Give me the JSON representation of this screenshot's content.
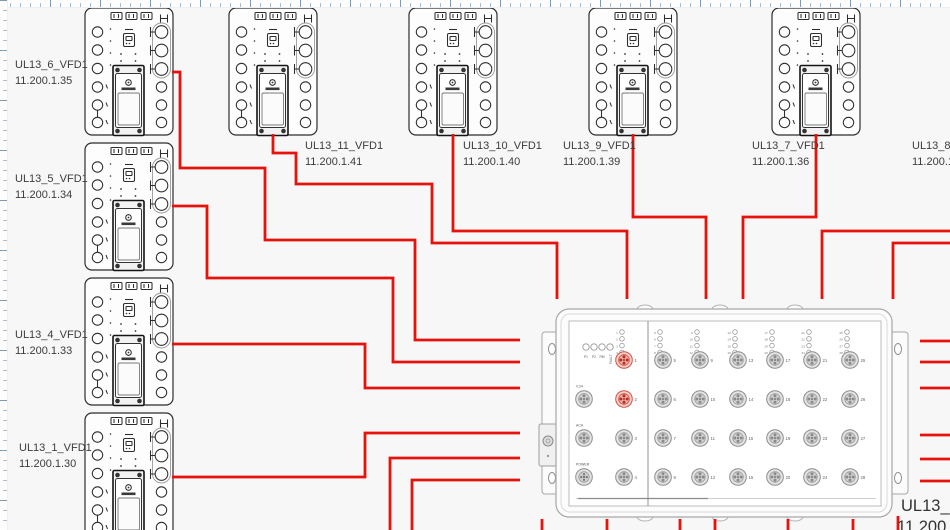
{
  "canvas": {
    "width": 950,
    "height": 530,
    "background": "#f7f7f8"
  },
  "palette": {
    "cable": "#e8120c",
    "device_stroke": "#2d2d2d",
    "switch_stroke": "#a7a7a7",
    "label_color": "#3c3c3c",
    "port_highlight_fill": "#f8cdc8",
    "port_highlight_stroke": "#cf5549"
  },
  "devices": [
    {
      "name": "UL13_6_VFD1",
      "ip": "11.200.1.35",
      "x": 84,
      "y": 7,
      "label_x": 15,
      "label_y": 58
    },
    {
      "name": "UL13_5_VFD1",
      "ip": "11.200.1.34",
      "x": 84,
      "y": 142,
      "label_x": 15,
      "label_y": 172
    },
    {
      "name": "UL13_4_VFD1",
      "ip": "11.200.1.33",
      "x": 84,
      "y": 277,
      "label_x": 15,
      "label_y": 328
    },
    {
      "name": "UL13_1_VFD1",
      "ip": "11.200.1.30",
      "x": 84,
      "y": 412,
      "label_x": 19,
      "label_y": 441
    },
    {
      "name": "UL13_11_VFD1",
      "ip": "11.200.1.41",
      "x": 228,
      "y": 7,
      "label_x": 305,
      "label_y": 139
    },
    {
      "name": "UL13_10_VFD1",
      "ip": "11.200.1.40",
      "x": 408,
      "y": 7,
      "label_x": 463,
      "label_y": 139
    },
    {
      "name": "UL13_9_VFD1",
      "ip": "11.200.1.39",
      "x": 588,
      "y": 7,
      "label_x": 563,
      "label_y": 139
    },
    {
      "name": "UL13_7_VFD1",
      "ip": "11.200.1.36",
      "x": 771,
      "y": 7,
      "label_x": 752,
      "label_y": 139
    }
  ],
  "clipped_label": {
    "name": "UL13_8",
    "ip": "11.200.1"
  },
  "switch": {
    "label": "UL13_",
    "label_ip": "11.200",
    "status_leds": [
      "P1",
      "P2",
      "RM",
      "FAULT"
    ],
    "aux_ports": [
      "V.24",
      "ACA",
      "POWER"
    ],
    "base_ports": [
      1,
      2,
      3,
      4
    ],
    "port_columns": [
      [
        5,
        6,
        7,
        8
      ],
      [
        9,
        10,
        11,
        12
      ],
      [
        13,
        14,
        15,
        16
      ],
      [
        17,
        18,
        19,
        20
      ],
      [
        21,
        22,
        23,
        24
      ],
      [
        25,
        26,
        27,
        28
      ]
    ],
    "highlighted_ports": [
      1,
      2
    ]
  },
  "cables": [
    {
      "id": "cable-UL13_6_VFD1",
      "points": [
        [
          172,
          72
        ],
        [
          180,
          72
        ],
        [
          180,
          168
        ],
        [
          265,
          168
        ],
        [
          265,
          240
        ],
        [
          415,
          240
        ],
        [
          415,
          340
        ],
        [
          520,
          340
        ]
      ]
    },
    {
      "id": "cable-UL13_5_VFD1",
      "points": [
        [
          172,
          206
        ],
        [
          207,
          206
        ],
        [
          207,
          278
        ],
        [
          393,
          278
        ],
        [
          393,
          362
        ],
        [
          520,
          362
        ]
      ]
    },
    {
      "id": "cable-UL13_4_VFD1",
      "points": [
        [
          172,
          344
        ],
        [
          365,
          344
        ],
        [
          365,
          388
        ],
        [
          520,
          388
        ]
      ]
    },
    {
      "id": "cable-UL13_1_VFD1",
      "points": [
        [
          172,
          477
        ],
        [
          365,
          477
        ],
        [
          365,
          433
        ],
        [
          520,
          433
        ]
      ]
    },
    {
      "id": "cable-bottom-feed-a",
      "points": [
        [
          390,
          530
        ],
        [
          390,
          458
        ],
        [
          520,
          458
        ]
      ]
    },
    {
      "id": "cable-bottom-feed-b",
      "points": [
        [
          412,
          530
        ],
        [
          412,
          480
        ],
        [
          520,
          480
        ]
      ]
    },
    {
      "id": "cable-UL13_11_VFD1",
      "points": [
        [
          273,
          134
        ],
        [
          273,
          153
        ],
        [
          296,
          153
        ],
        [
          296,
          184
        ],
        [
          432,
          184
        ],
        [
          432,
          243
        ],
        [
          557,
          243
        ],
        [
          557,
          299
        ]
      ]
    },
    {
      "id": "cable-UL13_10_VFD1",
      "points": [
        [
          453,
          134
        ],
        [
          453,
          231
        ],
        [
          627,
          231
        ],
        [
          627,
          299
        ]
      ]
    },
    {
      "id": "cable-UL13_9_VFD1",
      "points": [
        [
          633,
          134
        ],
        [
          633,
          217
        ],
        [
          706,
          217
        ],
        [
          706,
          299
        ]
      ]
    },
    {
      "id": "cable-UL13_7_VFD1",
      "points": [
        [
          816,
          134
        ],
        [
          816,
          217
        ],
        [
          743,
          217
        ],
        [
          743,
          299
        ]
      ]
    },
    {
      "id": "cable-right-feed-a",
      "points": [
        [
          950,
          231
        ],
        [
          822,
          231
        ],
        [
          822,
          299
        ]
      ]
    },
    {
      "id": "cable-right-feed-b",
      "points": [
        [
          950,
          243
        ],
        [
          893,
          243
        ],
        [
          893,
          299
        ]
      ]
    },
    {
      "id": "cable-stub-b1",
      "points": [
        [
          542,
          519
        ],
        [
          542,
          530
        ]
      ]
    },
    {
      "id": "cable-stub-b2",
      "points": [
        [
          607,
          519
        ],
        [
          607,
          530
        ]
      ]
    },
    {
      "id": "cable-stub-b3",
      "points": [
        [
          680,
          519
        ],
        [
          680,
          530
        ]
      ]
    },
    {
      "id": "cable-stub-b4",
      "points": [
        [
          715,
          519
        ],
        [
          715,
          530
        ]
      ]
    },
    {
      "id": "cable-stub-b5",
      "points": [
        [
          788,
          519
        ],
        [
          788,
          530
        ]
      ]
    },
    {
      "id": "cable-stub-b6",
      "points": [
        [
          853,
          519
        ],
        [
          853,
          530
        ]
      ]
    },
    {
      "id": "cable-stub-b7",
      "points": [
        [
          898,
          516
        ],
        [
          898,
          530
        ]
      ]
    },
    {
      "id": "cable-stub-r1",
      "points": [
        [
          920,
          341
        ],
        [
          950,
          341
        ]
      ]
    },
    {
      "id": "cable-stub-r2",
      "points": [
        [
          920,
          362
        ],
        [
          950,
          362
        ]
      ]
    },
    {
      "id": "cable-stub-r3",
      "points": [
        [
          920,
          388
        ],
        [
          950,
          388
        ]
      ]
    },
    {
      "id": "cable-stub-r4",
      "points": [
        [
          920,
          435
        ],
        [
          950,
          435
        ]
      ]
    },
    {
      "id": "cable-stub-r5",
      "points": [
        [
          920,
          459
        ],
        [
          950,
          459
        ]
      ]
    },
    {
      "id": "cable-stub-r6",
      "points": [
        [
          920,
          481
        ],
        [
          950,
          481
        ]
      ]
    }
  ]
}
